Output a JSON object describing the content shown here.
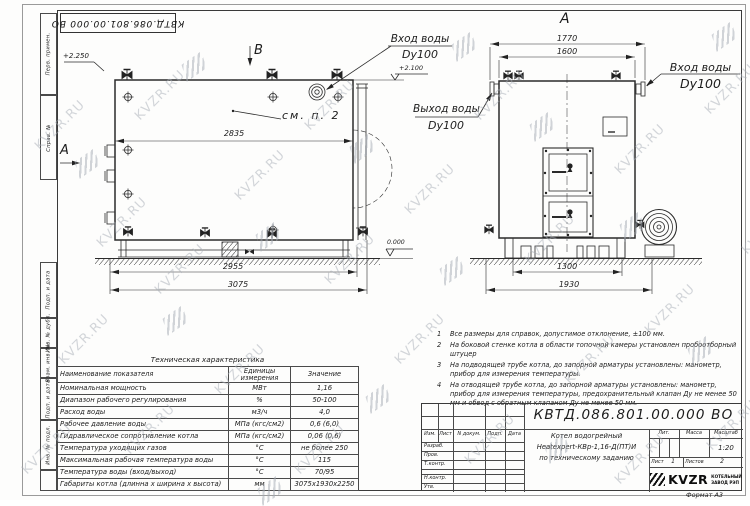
{
  "watermark": {
    "text": "KVZR.RU"
  },
  "stamp": {
    "doc_number": "КВТД.086.801.00.000 ВО"
  },
  "frame": {
    "strips": [
      "Перв. примен.",
      "Справ. №",
      "Подп. и дата",
      "Инв. № дубл.",
      "Взам. инв. №",
      "Подп. и дата",
      "Инв. № подл."
    ],
    "format_label": "Формат  А3"
  },
  "drawing": {
    "side_view": {
      "section_a": "А",
      "section_b": "В",
      "see_note": "см. п. 2",
      "dim_inner": "2835",
      "dim_base": "2955",
      "dim_overall": "3075",
      "elev_top": "+2.250",
      "elev_zero": "0.000"
    },
    "front_view": {
      "view_label": "А",
      "dim_flanges": "1770",
      "dim_shell": "1600",
      "dim_base": "1300",
      "dim_overall": "1930",
      "elev_outlet": "+2.100"
    },
    "ports": {
      "inlet_top": {
        "name": "Вход воды",
        "dn": "Dy100"
      },
      "outlet": {
        "name": "Выход воды",
        "dn": "Dy100"
      },
      "inlet_front": {
        "name": "Вход воды",
        "dn": "Dy100"
      }
    }
  },
  "tech_table": {
    "title": "Техническая характеристика",
    "col_param": "Наименование показателя",
    "col_units": "Единицы измерения",
    "col_value": "Значение",
    "rows": [
      [
        "Номинальная мощность",
        "МВт",
        "1,16"
      ],
      [
        "Диапазон рабочего регулирования",
        "%",
        "50-100"
      ],
      [
        "Расход воды",
        "м3/ч",
        "4,0"
      ],
      [
        "Рабочее давление воды",
        "МПа (кгс/см2)",
        "0,6 (6,0)"
      ],
      [
        "Гидравлическое сопротивление котла",
        "МПа (кгс/см2)",
        "0,06 (0,6)"
      ],
      [
        "Температура уходящих газов",
        "°С",
        "не более 250"
      ],
      [
        "Максимальная рабочая температура воды",
        "°С",
        "115"
      ],
      [
        "Температура воды (вход/выход)",
        "°С",
        "70/95"
      ],
      [
        "Габариты котла (длинна х ширина х высота)",
        "мм",
        "3075х1930х2250"
      ]
    ]
  },
  "notes": [
    {
      "num": "1",
      "text": "Все размеры для справок, допустимое отклонение, ±100 мм."
    },
    {
      "num": "2",
      "text": "На боковой стенке котла в области топочной камеры установлен пробоотборный штуцер"
    },
    {
      "num": "3",
      "text": "На подводящей трубе котла, до запорной арматуры установлены: манометр, прибор для измерения температуры."
    },
    {
      "num": "4",
      "text": "На отводящей трубе котла, до запорной арматуры установлены: манометр, прибор для измерения температуры, предохранительный клапан Ду не менее 50 мм и обвод с обратным клапаном Ду не менее 50 мм."
    }
  ],
  "title_block": {
    "doc_number": "КВТД.086.801.00.000  ВО",
    "product_line1": "Котел водогрейный",
    "product_line2": "Heatexpert-КВр-1,16-Д(ПТ)И",
    "product_line3": "по техническому заданию",
    "cols": {
      "izm": "Изм.",
      "list": "Лист",
      "ndok": "N докум.",
      "podp": "Подп.",
      "data": "Дата"
    },
    "rows": {
      "razrab": "Разраб.",
      "prov": "Пров.",
      "tkontr": "Т.контр.",
      "nkontr": "Н.контр.",
      "utv": "Утв."
    },
    "lit": "Лит.",
    "massa": "Масса",
    "masshtab": "Масштаб",
    "scale": "1:20",
    "list_label": "Лист",
    "list_value": "1",
    "listov_label": "Листов",
    "listov_value": "2",
    "logo_text": "KVZR",
    "logo_line1": "КОТЕЛЬНЫЙ",
    "logo_line2": "ЗАВОД РЭП"
  }
}
